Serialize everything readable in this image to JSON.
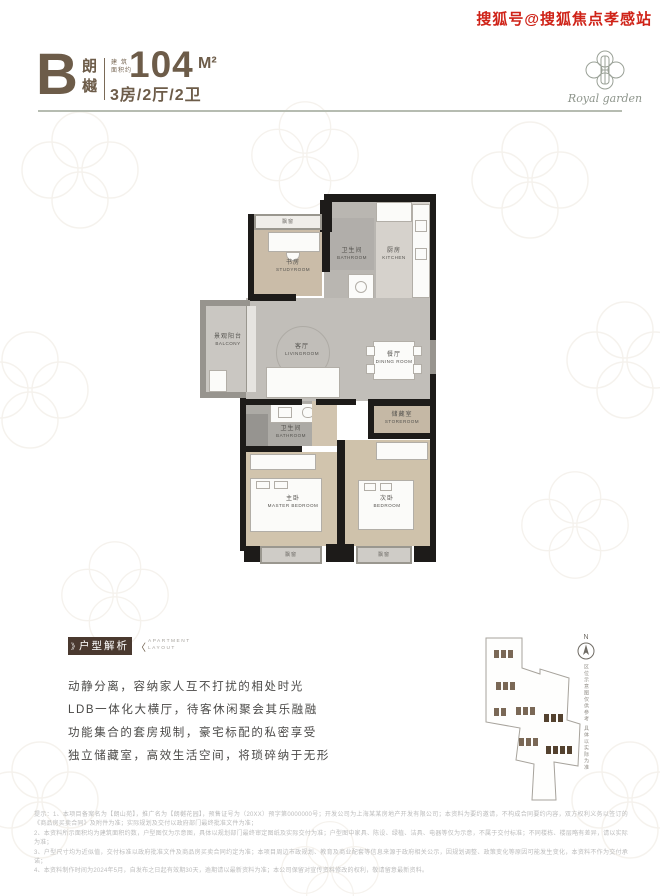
{
  "watermark": "搜狐号@搜狐焦点孝感站",
  "header": {
    "unit_letter": "B",
    "unit_name": "朗樾",
    "area_label_line1": "建筑",
    "area_label_line2": "面积约",
    "area_value": "104",
    "area_unit": "M²",
    "layout_spec": "3房/2厅/2卫",
    "logo_text": "Royal garden"
  },
  "floorplan": {
    "rooms": [
      {
        "cn": "书房",
        "en": "STUDYROOM"
      },
      {
        "cn": "卫生间",
        "en": "BATHROOM"
      },
      {
        "cn": "厨房",
        "en": "KITCHEN"
      },
      {
        "cn": "景观阳台",
        "en": "BALCONY"
      },
      {
        "cn": "客厅",
        "en": "LIVINGROOM"
      },
      {
        "cn": "餐厅",
        "en": "DINING ROOM"
      },
      {
        "cn": "储藏室",
        "en": "STOREROOM"
      },
      {
        "cn": "卫生间",
        "en": "BATHROOM"
      },
      {
        "cn": "主卧",
        "en": "MASTER BEDROOM"
      },
      {
        "cn": "次卧",
        "en": "BEDROOM"
      }
    ],
    "bay_window_label": "飘窗"
  },
  "analysis": {
    "badge_left_mark": "》",
    "badge_cn": "户型解析",
    "badge_right_mark": "〈",
    "badge_en_line1": "APARTMENT",
    "badge_en_line2": "LAYOUT",
    "lines": [
      "动静分离，容纳家人互不打扰的相处时光",
      "LDB一体化大横厅，待客休闲聚会其乐融融",
      "功能集合的套房规制，豪宅标配的私密享受",
      "独立储藏室，高效生活空间，将琐碎纳于无形"
    ]
  },
  "sitemap": {
    "north_label": "N",
    "side_text": "区位示意图仅供参考 具体以实际为准"
  },
  "disclaimer": {
    "lines": [
      "提示：1、本项目备案名为【朗山苑】，推广名为【朗樾花园】，预售证号为（20XX）预字第0000000号；开发公司为上海某某房地产开发有限公司；本资料为要约邀请，不构成合同要约内容，双方权利义务以签订的《商品房买卖合同》及附件为准；实际规划及交付以政府部门最终批准文件为准；",
      "2、本资料所示面积均为建筑面积约数，户型图仅为示意图，具体以规划部门最终审定图纸及实际交付为准；户型图中家具、陈设、绿植、洁具、电器等仅为示意，不属于交付标准；不同楼栋、楼层略有差异，请以实际为准；",
      "3、户型尺寸均为近似值，交付标准以政府批准文件及商品房买卖合同约定为准；本项目周边市政规划、教育及商业配套等信息来源于政府相关公示，因规划调整、政策变化等原因可能发生变化，本资料不作为交付承诺；",
      "4、本资料制作时间为2024年5月，自发布之日起有效期30天，逾期请以最新资料为准；本公司保留对宣传资料修改的权利，敬请留意最新资料。"
    ]
  },
  "colors": {
    "brand_brown": "#6d5c49",
    "badge_brown": "#4a392f",
    "watermark_red": "#cf2318",
    "wall_black": "#1d1b19",
    "rule_gray_green": "#b6bcb1"
  }
}
